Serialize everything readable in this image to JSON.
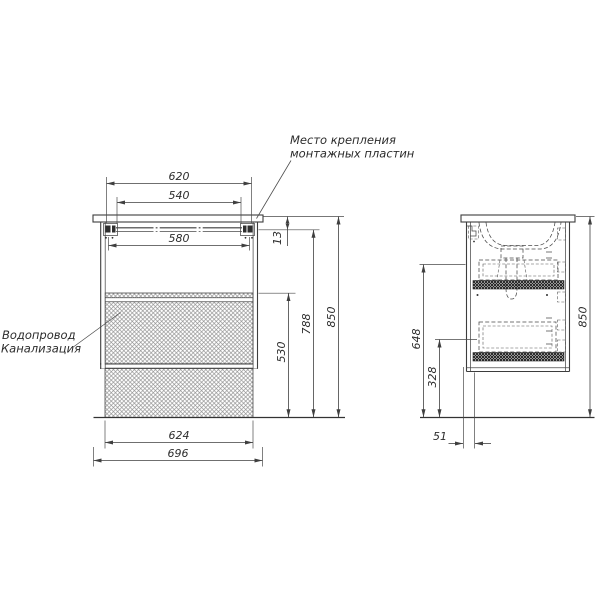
{
  "colors": {
    "background": "#ffffff",
    "line": "#3d3d3d",
    "text": "#2c2c2c",
    "hatch": "#8f8f8f"
  },
  "annotations": {
    "mounting_plates": {
      "line1": "Место крепления",
      "line2": "монтажных пластин"
    },
    "plumbing": {
      "line1": "Водопровод",
      "line2": "Канализация"
    }
  },
  "front_view": {
    "dimensions": {
      "mount_plates_outer_width": "620",
      "mount_plates_inner_width": "540",
      "rail_width": "580",
      "rail_top_offset": "13",
      "service_zone_height": "530",
      "rail_height_from_floor": "788",
      "overall_height": "850",
      "service_zone_width": "624",
      "overall_width": "696"
    }
  },
  "side_view": {
    "dimensions": {
      "bracket_height_from_floor": "648",
      "lower_clearance_height": "328",
      "overall_height": "850",
      "front_offset": "51"
    }
  }
}
